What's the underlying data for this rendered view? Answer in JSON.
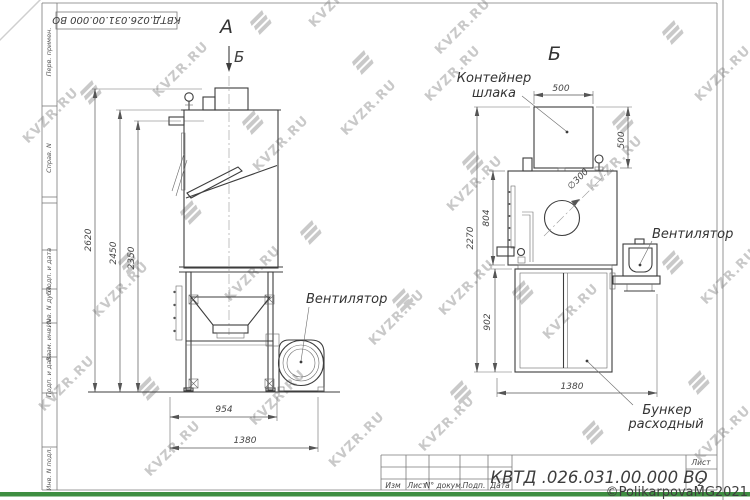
{
  "watermark": {
    "text": "KVZR.RU",
    "copyright": "©PolikarpovaMG2021"
  },
  "frame": {
    "stamp": "КВТД.026.031.00.000  ВО",
    "side_fields": [
      "Перв. примен.",
      "Справ. N",
      "Подп. и дата",
      "Инв. N дубл.",
      "Взам. инв. N",
      "Подп. и дата",
      "Инв. N подл."
    ]
  },
  "left_view": {
    "view_label": "А",
    "section_arrow_label": "Б",
    "fan_label": "Вентилятор",
    "dim_h_outer": "2620",
    "dim_h_mid": "2450",
    "dim_h_inner": "2350",
    "dim_w_frame": "954",
    "dim_w_total": "1380"
  },
  "right_view": {
    "view_title": "Б",
    "container_label_line1": "Контейнер",
    "container_label_line2": "шлака",
    "fan_label": "Вентилятор",
    "bunker_label_line1": "Бункер",
    "bunker_label_line2": "расходный",
    "dim_container_w": "500",
    "dim_container_h": "500",
    "dim_body_h": "804",
    "dim_total_h": "2270",
    "dim_bunker_h": "902",
    "dim_bottom_w": "1380",
    "dim_hole": "∅300"
  },
  "title_block": {
    "designation": "КВТД .026.031.00.000  ВО",
    "cols": [
      "Изм",
      "Лист",
      "N° докум.",
      "Подп.",
      "Дата"
    ],
    "sheet_label": "Лист",
    "sheet_number": "2"
  }
}
